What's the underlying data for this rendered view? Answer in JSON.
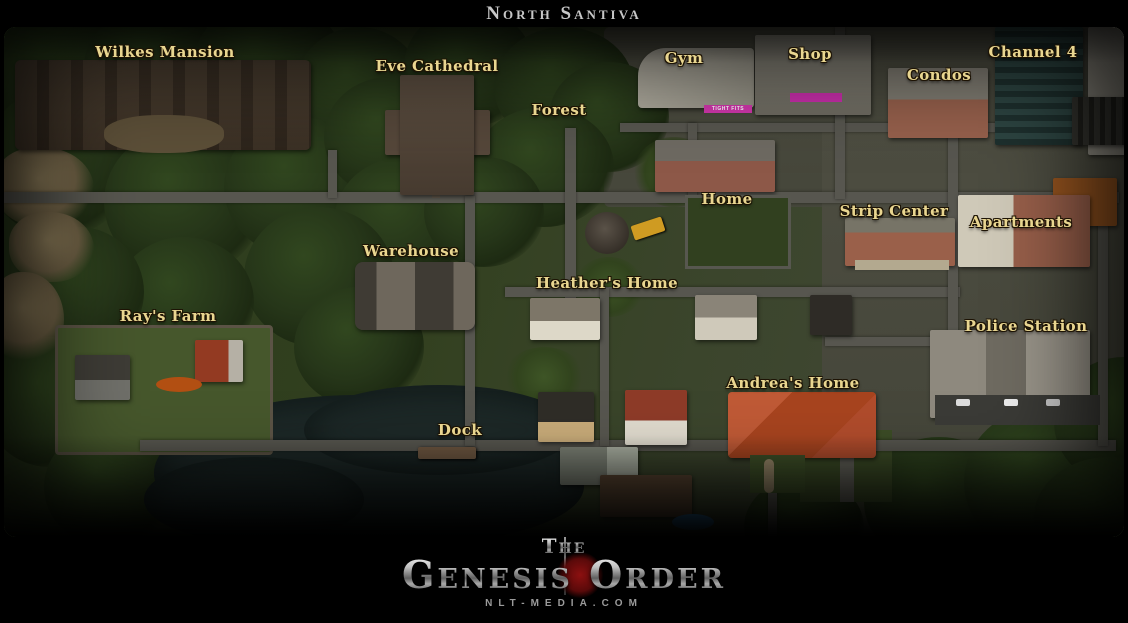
{
  "header": {
    "title": "North Santiva"
  },
  "map": {
    "locations": [
      {
        "id": "wilkes-mansion",
        "label": "Wilkes Mansion"
      },
      {
        "id": "eve-cathedral",
        "label": "Eve Cathedral"
      },
      {
        "id": "forest",
        "label": "Forest"
      },
      {
        "id": "gym",
        "label": "Gym"
      },
      {
        "id": "shop",
        "label": "Shop"
      },
      {
        "id": "condos",
        "label": "Condos"
      },
      {
        "id": "channel-4",
        "label": "Channel 4"
      },
      {
        "id": "home",
        "label": "Home"
      },
      {
        "id": "strip-center",
        "label": "Strip Center"
      },
      {
        "id": "apartments",
        "label": "Apartments"
      },
      {
        "id": "warehouse",
        "label": "Warehouse"
      },
      {
        "id": "heathers-home",
        "label": "Heather's Home"
      },
      {
        "id": "rays-farm",
        "label": "Ray's Farm"
      },
      {
        "id": "police-station",
        "label": "Police Station"
      },
      {
        "id": "andreas-home",
        "label": "Andrea's Home"
      },
      {
        "id": "dock",
        "label": "Dock"
      }
    ],
    "signs": {
      "gym": "TIGHT FITS"
    },
    "colors": {
      "label_gold": "#e9d690",
      "title_silver": "#c7c7c7",
      "water": "#1d2827",
      "road": "#57564f",
      "forest": "#263619",
      "grass": "#3b452c",
      "logo_orb_red": "#8c1010"
    }
  },
  "footer": {
    "logo_the": "The",
    "logo_main": "Genesis Order",
    "website": "NLT-MEDIA.COM"
  }
}
